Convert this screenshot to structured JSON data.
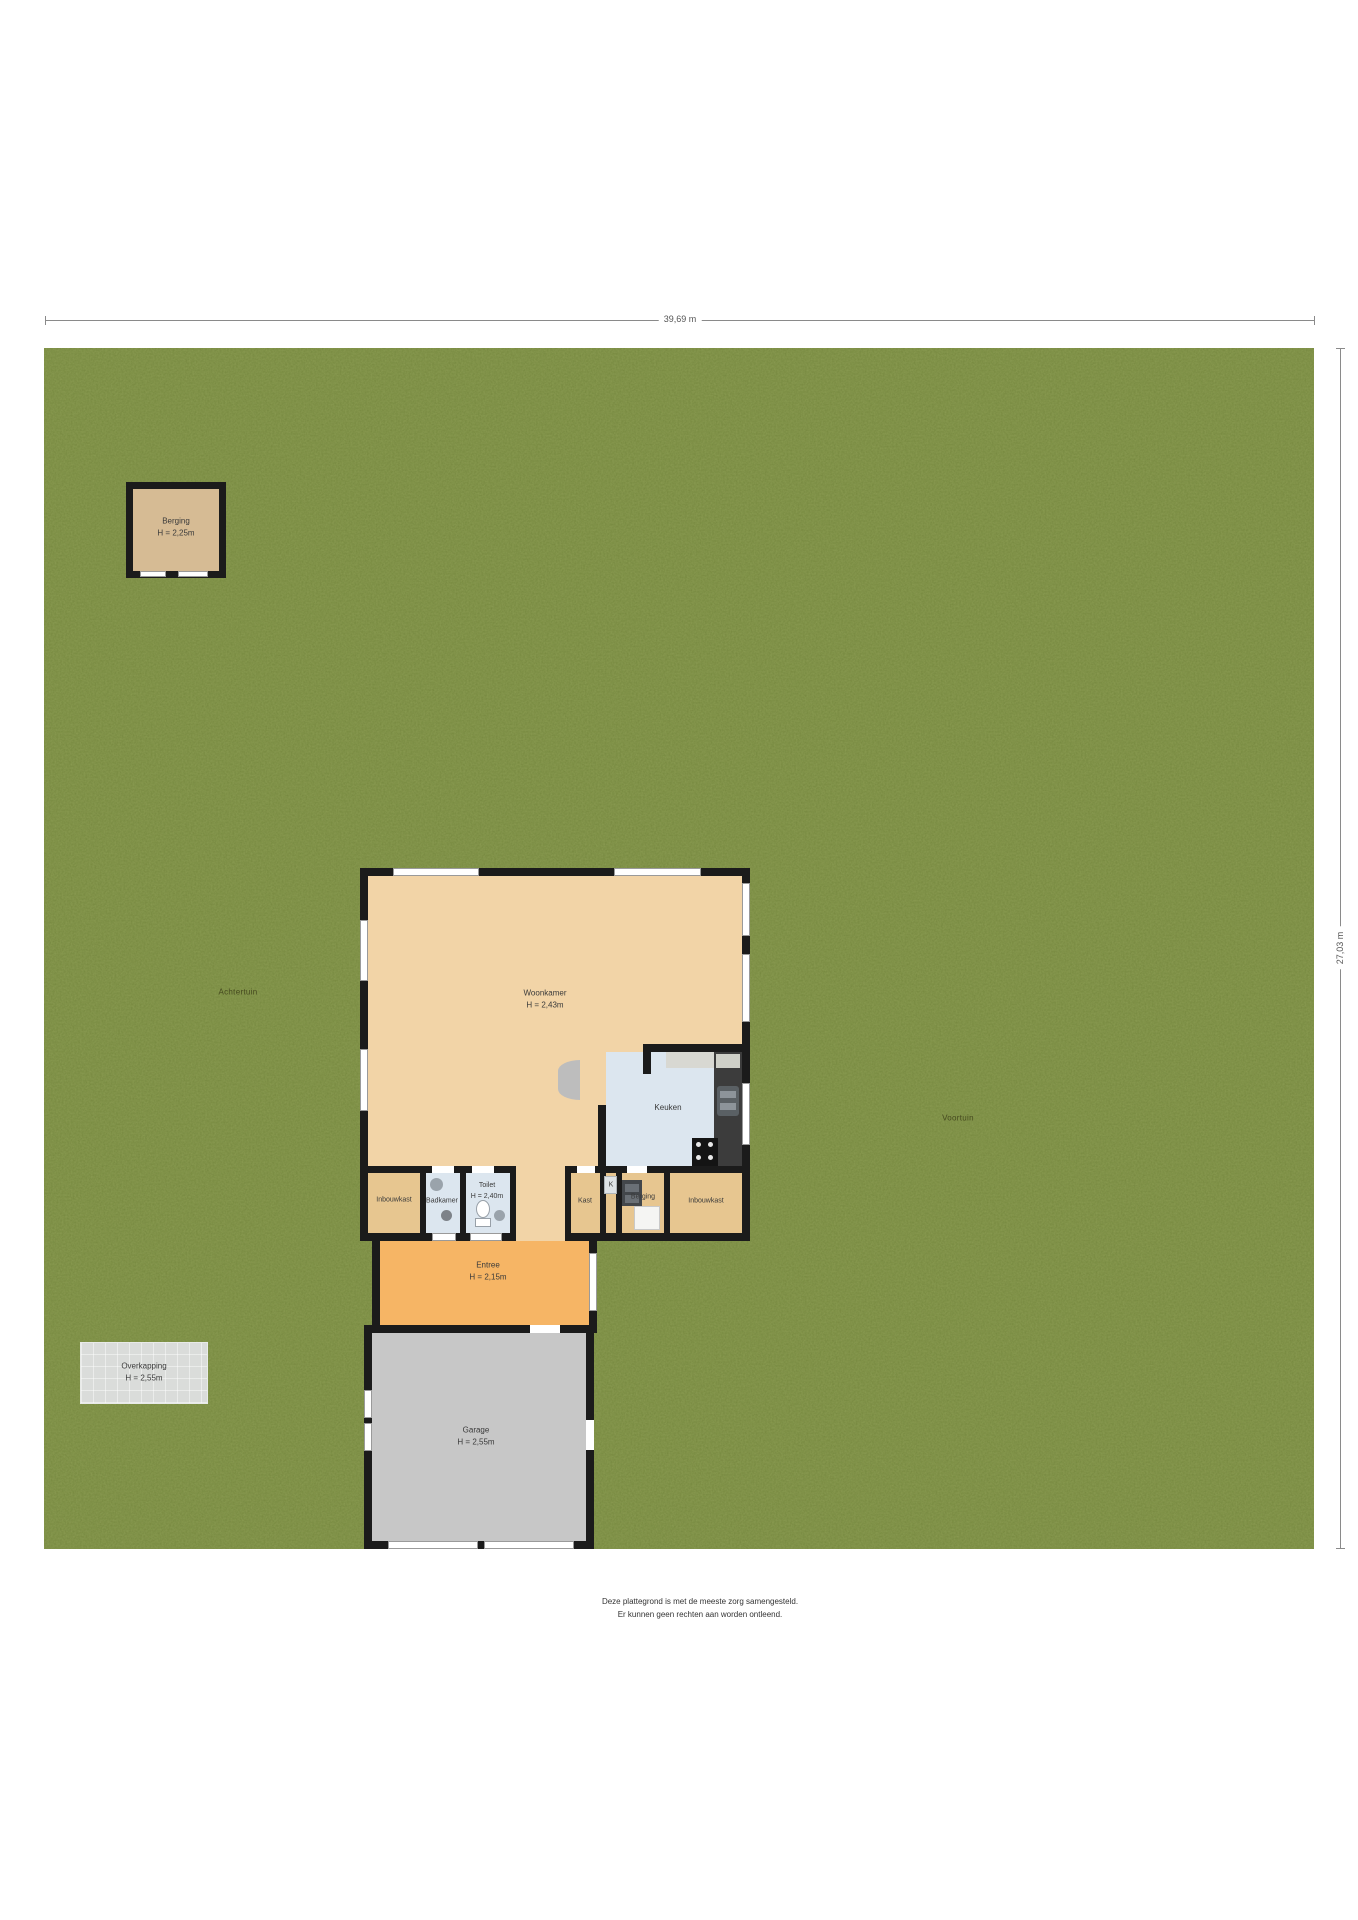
{
  "plan": {
    "dimensions": {
      "width_label": "39,69 m",
      "height_label": "27,03 m"
    },
    "garden": {
      "back": "Achtertuin",
      "front": "Voortuin"
    },
    "outbuildings": {
      "shed": {
        "name": "Berging",
        "height": "H = 2,25m"
      },
      "canopy": {
        "name": "Overkapping",
        "height": "H = 2,55m"
      }
    },
    "rooms": {
      "woonkamer": {
        "name": "Woonkamer",
        "height": "H = 2,43m"
      },
      "keuken": {
        "name": "Keuken"
      },
      "inbouwkast_links": {
        "name": "Inbouwkast"
      },
      "badkamer": {
        "name": "Badkamer"
      },
      "toilet": {
        "name": "Toilet",
        "height": "H = 2,40m"
      },
      "kast": {
        "name": "Kast"
      },
      "meterkast": {
        "name": "K"
      },
      "berging_binnen": {
        "name": "Berging"
      },
      "inbouwkast_rechts": {
        "name": "Inbouwkast"
      },
      "entree": {
        "name": "Entree",
        "height": "H = 2,15m"
      },
      "garage": {
        "name": "Garage",
        "height": "H = 2,55m"
      }
    },
    "disclaimer": {
      "line1": "Deze plattegrond is met de meeste zorg samengesteld.",
      "line2": "Er kunnen geen rechten aan worden ontleend."
    },
    "colors": {
      "grass": "#7c9044",
      "wall": "#1b1b1b",
      "living_floor": "#f2d4a7",
      "closet_floor": "#e7c690",
      "wet_floor": "#dce6ef",
      "entry_floor": "#f6b565",
      "garage_floor": "#c7c7c7",
      "shed_floor": "#d6bb94",
      "canopy": "#dadcda"
    }
  }
}
